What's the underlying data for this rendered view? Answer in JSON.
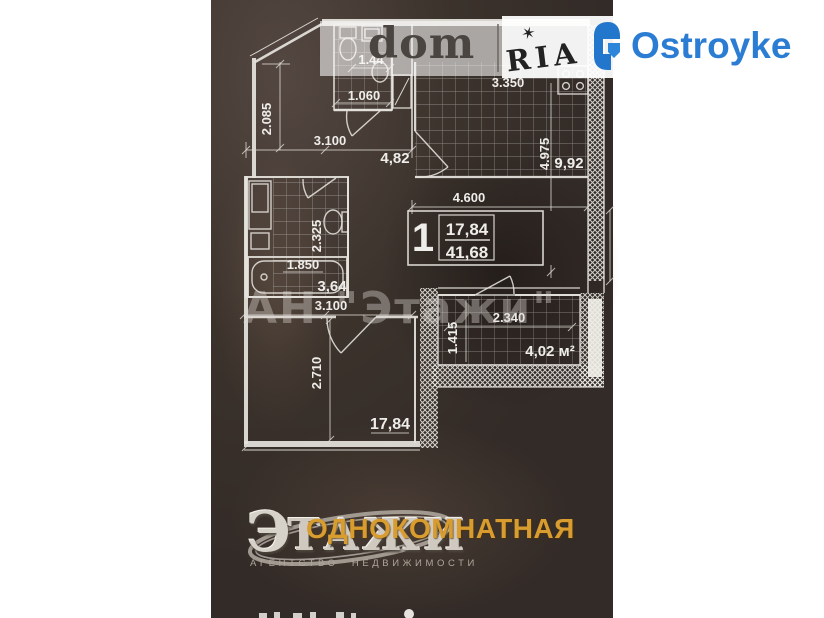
{
  "page": {
    "background": "#ffffff"
  },
  "photo": {
    "base_color": "#38302b"
  },
  "watermarks": {
    "domria": {
      "dom": "dom",
      "ria": "RIA",
      "star": "✶"
    },
    "center": "АН \"Этажи\""
  },
  "ostroyke": {
    "name": "Ostroyke",
    "color": "#2b7dd3"
  },
  "etazhi_logo": {
    "first": "Э",
    "rest": "ТАЖИ",
    "subtitle": "АГЕНТСТВО НЕДВИЖИМОСТИ"
  },
  "category_overlay": {
    "text": "ОДНОКОМНАТНАЯ",
    "color": "#d99c2f"
  },
  "plan": {
    "unit_box": {
      "number": "1",
      "living_area": "17,84",
      "total_area": "41,68"
    },
    "dims": {
      "wc_width": "1.44",
      "wc_width2": "1.060",
      "hall_h": "2.085",
      "hall_w": "3.100",
      "hall_area": "4,82",
      "kitchen_w": "3.350",
      "kitchen_h": "4.975",
      "kitchen_area": "9,92",
      "kitchen_w2": "4.600",
      "bath_h": "2.325",
      "bath_w": "1.850",
      "bath_area": "3,64",
      "living_w": "3.100",
      "living_h": "2.710",
      "living_area": "17,84",
      "balcony_w": "2.340",
      "balcony_h": "1.415",
      "balcony_area": "4,02 м²"
    }
  }
}
